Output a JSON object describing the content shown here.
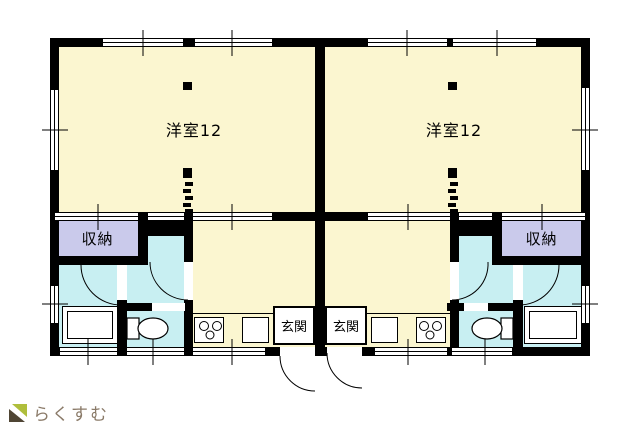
{
  "floor_plan": {
    "title": "two-unit apartment floor plan",
    "units": [
      {
        "id": "left",
        "main_room": "洋室12",
        "storage": "収納",
        "entrance": "玄関"
      },
      {
        "id": "right",
        "main_room": "洋室12",
        "storage": "収納",
        "entrance": "玄関"
      }
    ],
    "colors": {
      "room_fill": "#FBF6D0",
      "wet_area_fill": "#C8EFF2",
      "storage_fill": "#CACAEB",
      "wall": "#000000",
      "fixture_fill": "#FFFFFF"
    }
  },
  "logo": {
    "text": "らくすむ",
    "text_color": "#8A7A68",
    "icon_green": "#AFBE3C",
    "icon_brown": "#4F4534"
  }
}
